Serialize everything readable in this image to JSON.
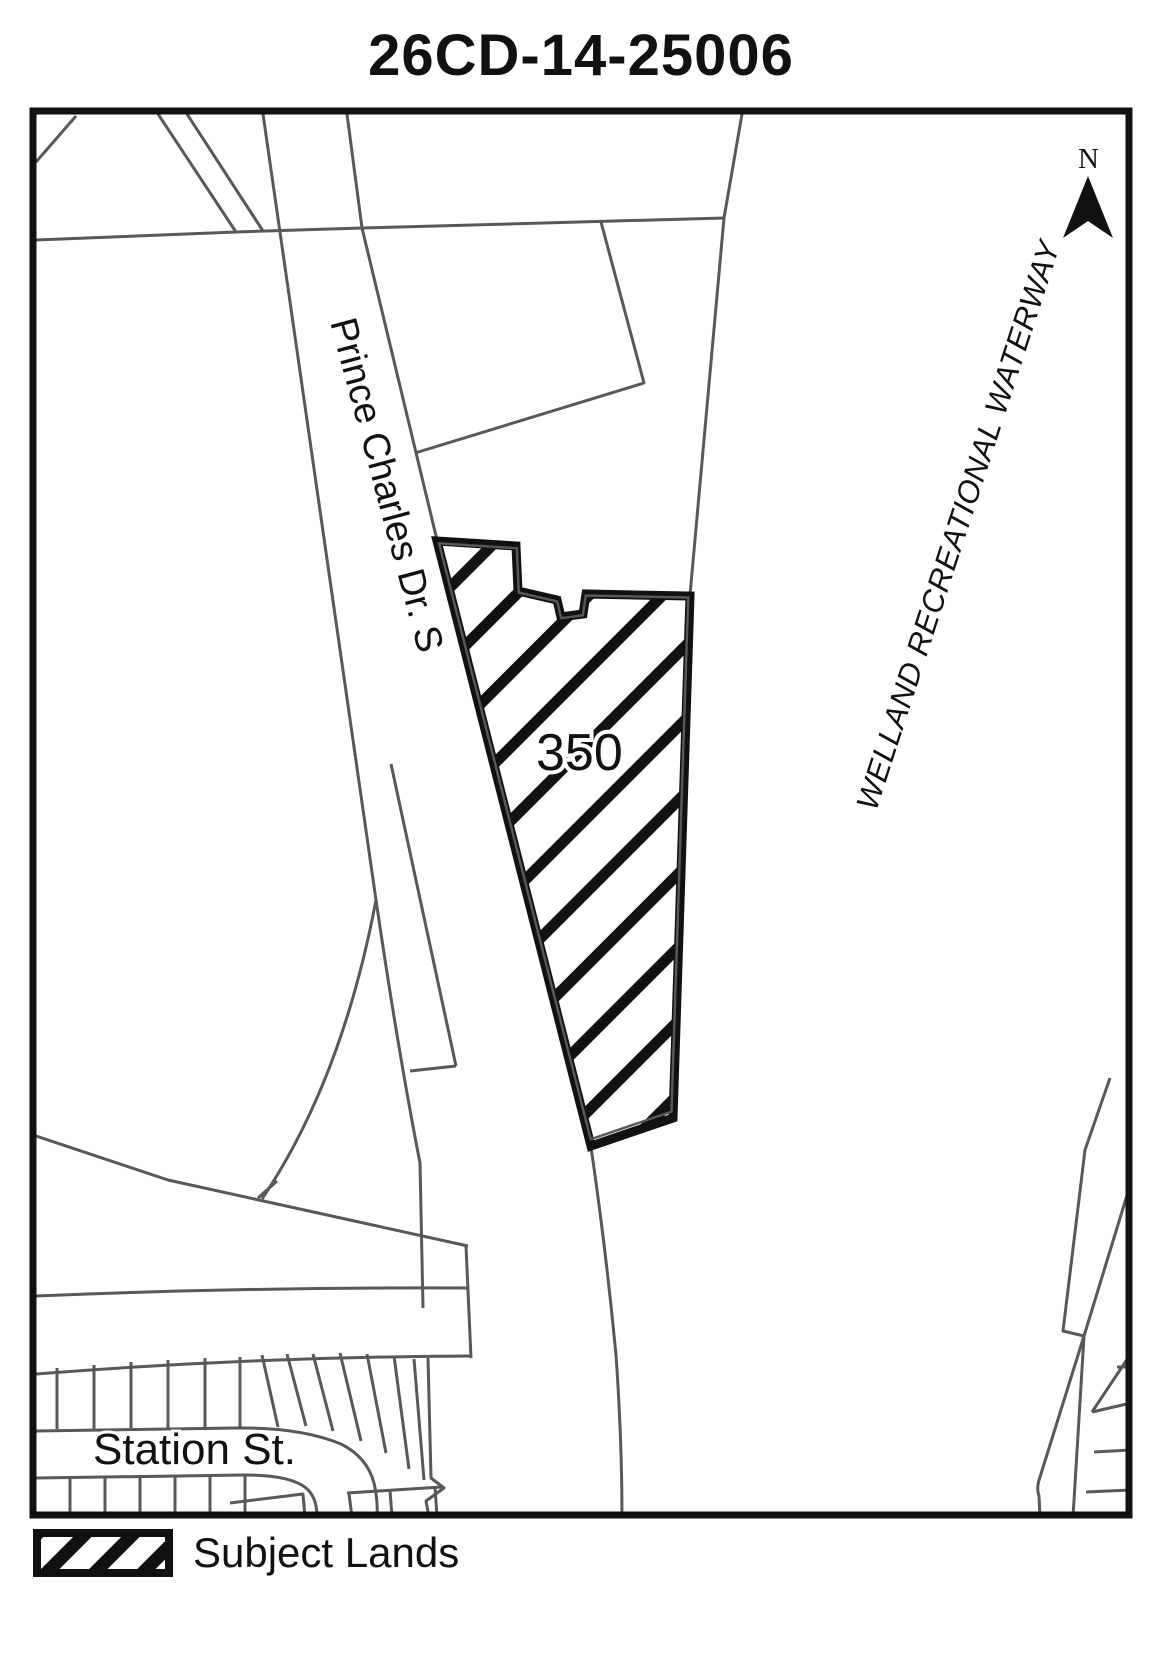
{
  "title": "26CD-14-25006",
  "map": {
    "parcel_label": "350",
    "street_label": "Prince Charles Dr. S",
    "cross_street_label": "Station St.",
    "waterway_label": "WELLAND RECREATIONAL WATERWAY",
    "north_label": "N",
    "colors": {
      "map_lines": "#58585b",
      "parcel_outline": "#111111",
      "hatch": "#111111",
      "background": "#ffffff"
    }
  },
  "legend": {
    "items": [
      {
        "swatch": "diagonal-hatch",
        "label": "Subject Lands"
      }
    ]
  }
}
